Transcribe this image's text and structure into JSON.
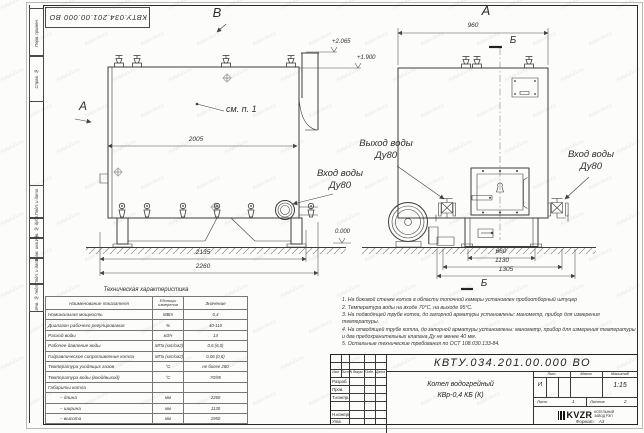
{
  "watermark": "kotel-kv.ru",
  "frame": {
    "doc_number_flipped": "КВТУ.034.201.00.000  ВО",
    "margin_labels": [
      "Перв. примен.",
      "Справ. №",
      "Подп. и дата",
      "Инв. № дубл.",
      "Взам. инв. №",
      "Подп. и дата",
      "Инв. № подл."
    ],
    "format_label": "Формат",
    "format_value": "А3"
  },
  "drawing": {
    "view_b": "В",
    "view_a": "А",
    "view_arrow": "А",
    "section_top": "Б",
    "section_bottom": "Б",
    "see_note": "см. п. 1",
    "dims": {
      "d2005": "2005",
      "d2135": "2135",
      "d2260": "2260",
      "d960": "960",
      "d660": "660",
      "d1130": "1130",
      "d1305": "1305"
    },
    "elevations": {
      "top": "+2.065",
      "mid": "+1.900",
      "zero": "0.000"
    },
    "labels": {
      "outlet_1": "Выход воды",
      "outlet_2": "Ду80",
      "inlet_a_1": "Вход воды",
      "inlet_a_2": "Ду80",
      "inlet_b_1": "Вход воды",
      "inlet_b_2": "Ду80"
    }
  },
  "spec_table": {
    "title": "Техническая характеристика",
    "headers": {
      "name": "Наименование показателя",
      "units": "Единицы измерения",
      "value": "Значение"
    },
    "rows": [
      {
        "name": "Номинальная мощность",
        "units": "МВт",
        "value": "0,4"
      },
      {
        "name": "Диапазон рабочего регулирования",
        "units": "%",
        "value": "40-110"
      },
      {
        "name": "Расход воды",
        "units": "м3/ч",
        "value": "14"
      },
      {
        "name": "Рабочее давление воды",
        "units": "МПа (кгс/см2)",
        "value": "0,6 (6,0)"
      },
      {
        "name": "Гидравлическое сопротивление котла",
        "units": "МПа (кгс/см2)",
        "value": "0,06 (0,6)"
      },
      {
        "name": "Температура уходящих газов",
        "units": "°С",
        "value": "не более 280"
      },
      {
        "name": "Температура воды (вход/выход)",
        "units": "°С",
        "value": "70/95"
      },
      {
        "name": "Габариты котла",
        "units": "",
        "value": ""
      },
      {
        "name": "– длина",
        "units": "мм",
        "value": "2260"
      },
      {
        "name": "– ширина",
        "units": "мм",
        "value": "1130"
      },
      {
        "name": "– высота",
        "units": "мм",
        "value": "1950"
      }
    ]
  },
  "notes": [
    "1. На боковой стенке котла в области топочной камеры установлен пробоотборный штуцер",
    "2. Температура воды на входе 70°С, на выходе 95°С.",
    "3. На подводящей трубе котла, до запорной арматуры установлены: манометр, прибор для измерения температуры.",
    "4. На отводящей трубе котла, до запорной арматуры установлены: манометр, прибор для измерения температуры и два предохранительных клапана Ду не менее 40 мм.",
    "5. Остальные технические требования по ОСТ 108.030.133-84."
  ],
  "title_block": {
    "doc_number": "КВТУ.034.201.00.000  ВО",
    "rev_cols": [
      "Изм.",
      "Лист",
      "N докум.",
      "Подп.",
      "Дата"
    ],
    "sig_rows": [
      "Разраб.",
      "Пров.",
      "Т.контр.",
      "Н.контр.",
      "Утв."
    ],
    "product_line1": "Котел водогрейный",
    "product_line2": "КВр-0,4  КБ  (К)",
    "lit_label": "Лит.",
    "mass_label": "Масса",
    "scale_label": "Масштаб",
    "lit_value": "И",
    "scale_value": "1:15",
    "sheet_label": "Лист",
    "sheet_value": "1",
    "sheets_label": "Листов",
    "sheets_value": "2",
    "logo_text": "KVZR",
    "company_line1": "КОТЕЛЬНЫЙ",
    "company_line2": "ЗАВОД РЭП"
  }
}
